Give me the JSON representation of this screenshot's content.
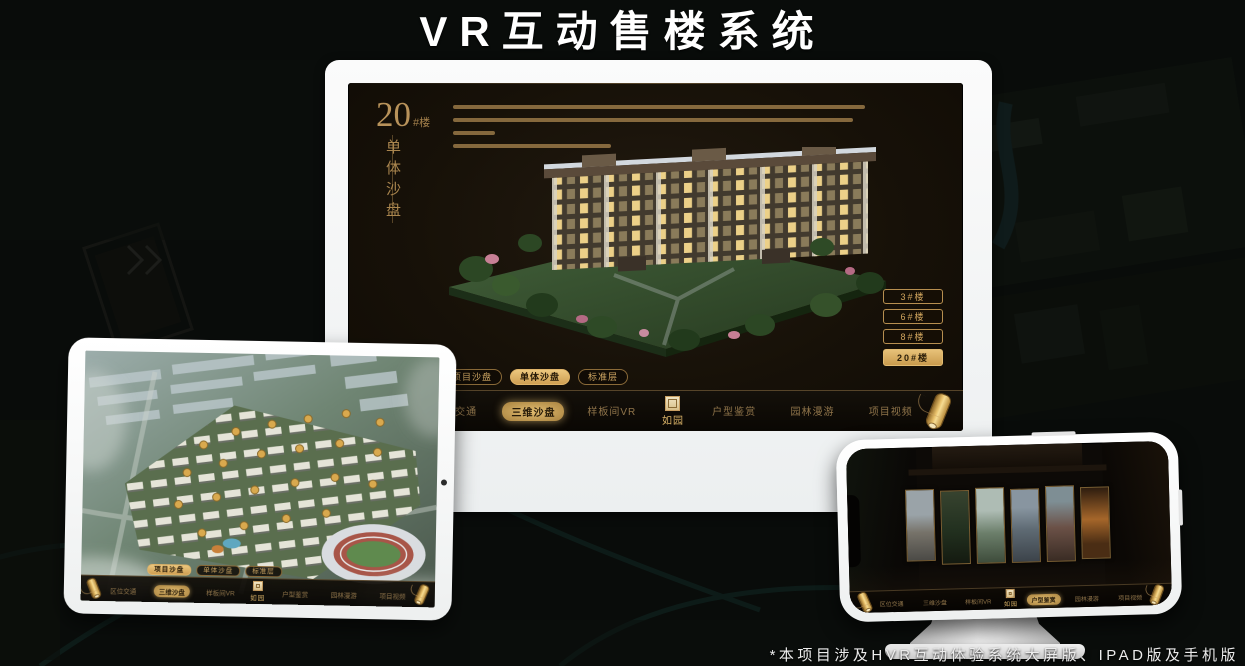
{
  "page": {
    "title": "VR互动售楼系统",
    "footnote": "*本项目涉及HVR互动体验系统大屏版、IPAD版及手机版"
  },
  "colors": {
    "gold": "#c9a063",
    "gold_fill": "#d9b267",
    "screen_bg": "#171108",
    "selected_text": "#241806"
  },
  "monitor_app": {
    "heading": {
      "number": "20",
      "suffix": "#楼",
      "vertical": "单体沙盘"
    },
    "floor_buttons": [
      {
        "label": "3#楼",
        "active": false
      },
      {
        "label": "6#楼",
        "active": false
      },
      {
        "label": "8#楼",
        "active": false
      },
      {
        "label": "20#楼",
        "active": true
      }
    ],
    "sub_tabs": [
      {
        "label": "项目沙盘",
        "active": false
      },
      {
        "label": "单体沙盘",
        "active": true
      },
      {
        "label": "标准层",
        "active": false
      }
    ],
    "nav_items": [
      {
        "label": "区位交通",
        "active": false
      },
      {
        "label": "三维沙盘",
        "active": true
      },
      {
        "label": "样板间VR",
        "active": false
      },
      {
        "label": "户型鉴赏",
        "active": false
      },
      {
        "label": "园林漫游",
        "active": false
      },
      {
        "label": "项目视频",
        "active": false
      }
    ],
    "logo": "如园"
  },
  "tablet_app": {
    "sub_tabs": [
      {
        "label": "项目沙盘",
        "active": true
      },
      {
        "label": "单体沙盘",
        "active": false
      },
      {
        "label": "标准层",
        "active": false
      }
    ],
    "nav_items": [
      {
        "label": "区位交通",
        "active": false
      },
      {
        "label": "三维沙盘",
        "active": true
      },
      {
        "label": "样板间VR",
        "active": false
      },
      {
        "label": "户型鉴赏",
        "active": false
      },
      {
        "label": "园林漫游",
        "active": false
      },
      {
        "label": "项目视频",
        "active": false
      }
    ],
    "logo": "如园"
  },
  "phone_app": {
    "nav_items": [
      {
        "label": "区位交通",
        "active": false
      },
      {
        "label": "三维沙盘",
        "active": false
      },
      {
        "label": "样板间VR",
        "active": false
      },
      {
        "label": "户型鉴赏",
        "active": true
      },
      {
        "label": "园林漫游",
        "active": false
      },
      {
        "label": "项目视频",
        "active": false
      }
    ],
    "logo": "如园"
  }
}
